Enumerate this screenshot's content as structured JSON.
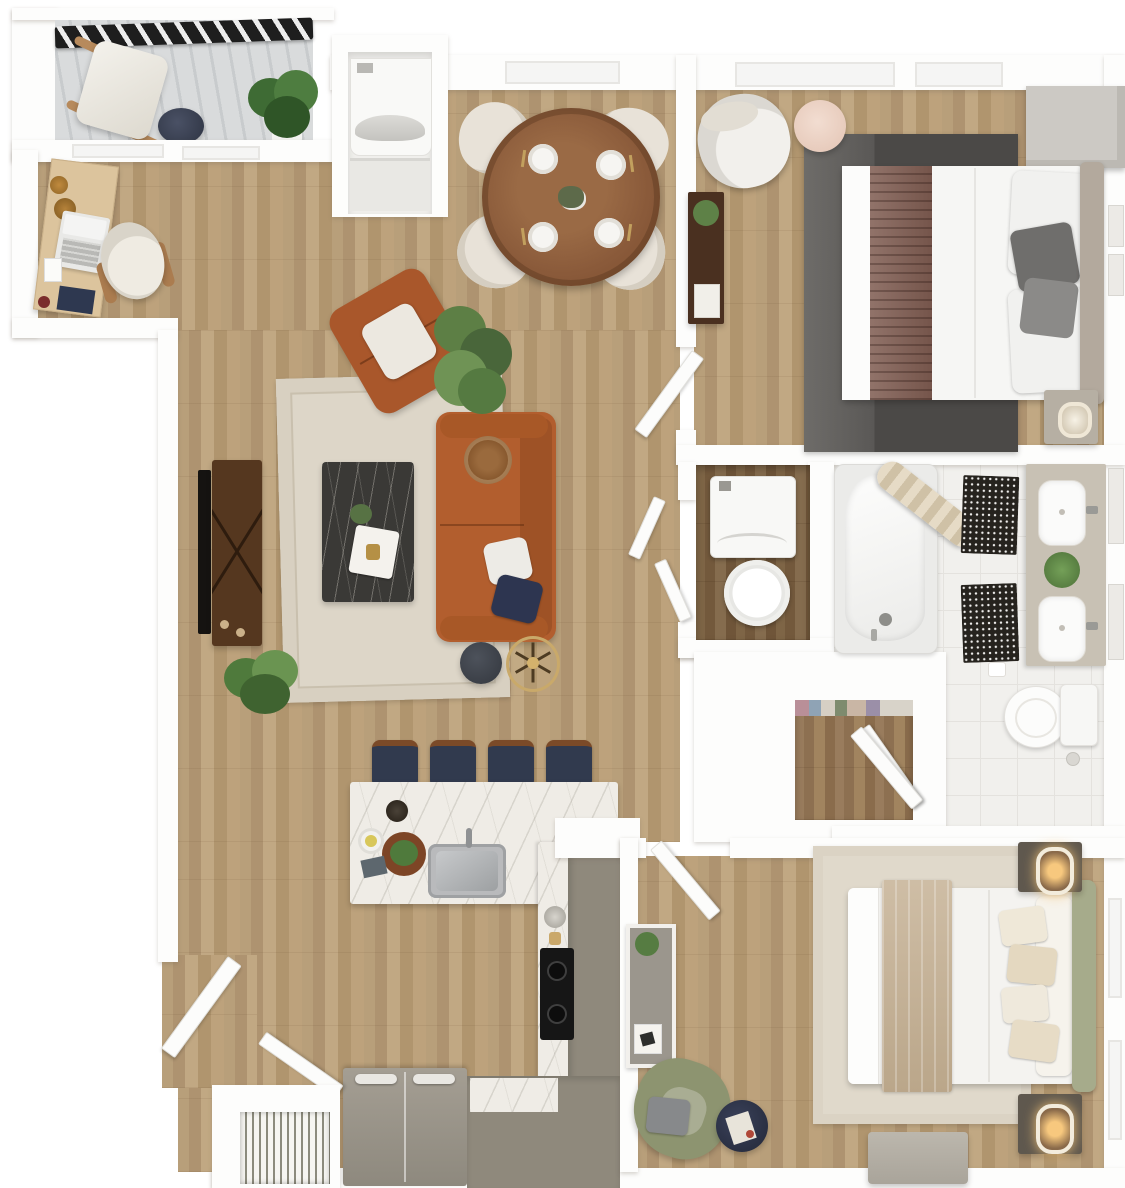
{
  "meta": {
    "image_type": "3D rendered top-down apartment floor plan",
    "visible_text": "none",
    "unit_summary": "one-level unit with living room, dining area, kitchen, two bedrooms, bathroom, walk-in closet, laundry closets, office nook, entry and balcony"
  },
  "palette": {
    "wall": "#fdfdfc",
    "wood_floor": "#b49b76",
    "dark_wood_floor": "#7b6245",
    "bath_tile": "#f1f0ed",
    "balcony_concrete": "#d9dbdc",
    "railing_black": "#1e1e1e",
    "rug_cream": "#ded7c9",
    "rug_dark_gray": "#4d4b49",
    "rug_beige": "#e0d9cb",
    "sofa_leather": "#b25e2e",
    "coffee_table_marble": "#3a3936",
    "tv_console_walnut": "#55371f",
    "kitchen_marble": "#efece6",
    "cabinet_taupe": "#8f897c",
    "stool_navy": "#313a4e",
    "cooktop_black": "#161616",
    "bed_white": "#f6f6f4",
    "runner_brown": "#7f5c51",
    "runner_tan": "#c9b69b",
    "headboard_taupe": "#b3a99d",
    "headboard_sage": "#a6ab8b",
    "armchair_sage": "#8d9470",
    "accent_navy": "#2b3144",
    "plant_green": "#55783f",
    "brass": "#c2a05e"
  },
  "rooms": [
    {
      "id": "balcony",
      "label": "Balcony",
      "furniture": [
        "metal railing",
        "wood lounge chair with white cushion",
        "navy round side table",
        "potted fiddle-leaf plant"
      ]
    },
    {
      "id": "office-nook",
      "label": "Office Nook",
      "furniture": [
        "wood writing desk",
        "white laptop",
        "desk accessories",
        "white office chair with wood arms"
      ]
    },
    {
      "id": "utility-closet",
      "label": "Utility Closet",
      "furniture": [
        "stacked washer dryer"
      ]
    },
    {
      "id": "dining-area",
      "label": "Dining Area",
      "furniture": [
        "round wood dining table",
        "four cream shell chairs",
        "four place settings with gold cutlery",
        "centerpiece"
      ]
    },
    {
      "id": "living-room",
      "label": "Living Room",
      "furniture": [
        "tv console",
        "flat tv",
        "cream area rug",
        "dark marble coffee table",
        "cognac leather sofa",
        "rattan pillow",
        "white pillow",
        "navy pillow",
        "cognac leather armchair",
        "large floor plant",
        "small floor plant",
        "dark round side table",
        "brass spoke accent table"
      ]
    },
    {
      "id": "kitchen",
      "label": "Kitchen",
      "furniture": [
        "marble island with sink",
        "four navy bar stools",
        "faucet",
        "cutting board and dishes",
        "cooktop with two burners",
        "taupe cabinet run",
        "refrigerator",
        "base cabinets"
      ]
    },
    {
      "id": "bedroom-1",
      "label": "Bedroom 1",
      "furniture": [
        "queen bed with striped runner",
        "dark gray area rug",
        "gray wardrobe cabinet",
        "white accent chair",
        "blush round side table",
        "walnut dresser with plant",
        "nightstand with lamp",
        "wall art"
      ]
    },
    {
      "id": "bathroom",
      "label": "Bathroom",
      "furniture": [
        "bathtub",
        "shower curtain",
        "two mosaic bath mats",
        "double vanity",
        "two vessel sinks",
        "plant",
        "toilet",
        "wall mirrors"
      ]
    },
    {
      "id": "laundry-closet",
      "label": "Laundry Closet",
      "furniture": [
        "washer",
        "round laundry basket",
        "double doors"
      ]
    },
    {
      "id": "walk-in-closet",
      "label": "Walk-in Closet",
      "furniture": [
        "hanging clothes",
        "door"
      ]
    },
    {
      "id": "bedroom-2",
      "label": "Bedroom 2",
      "furniture": [
        "queen bed with tan runner",
        "sage headboard",
        "beige area rug",
        "two nightstands with glowing lamps",
        "gray dresser with plant",
        "sage green armchair",
        "navy round side table",
        "bench"
      ]
    },
    {
      "id": "entry",
      "label": "Entry",
      "furniture": [
        "entry door leaves",
        "hvac closet with vent grate"
      ]
    }
  ]
}
